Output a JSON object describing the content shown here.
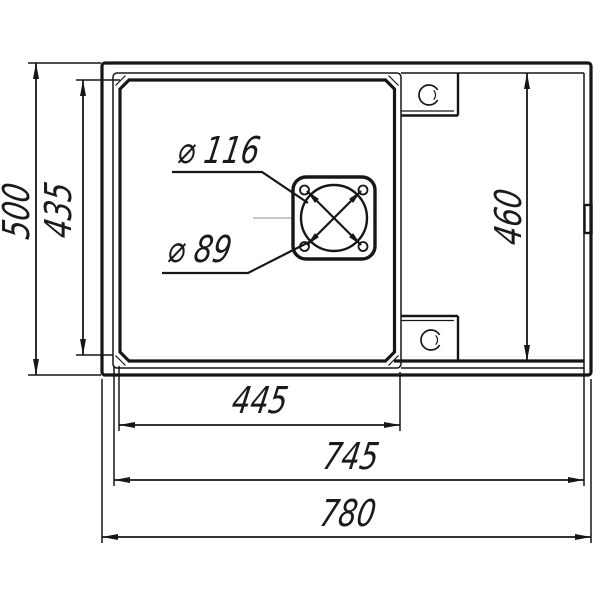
{
  "drawing": {
    "background_color": "#ffffff",
    "ink_color": "#161616",
    "centerline_color": "#a3a3a3",
    "dimensions": {
      "overall_width": "780",
      "board_width": "745",
      "bowl_width": "445",
      "overall_depth": "500",
      "bowl_depth": "435",
      "board_depth": "460"
    },
    "drain": {
      "flange_diameter": "⌀ 116",
      "drain_diameter": "⌀ 89"
    }
  }
}
